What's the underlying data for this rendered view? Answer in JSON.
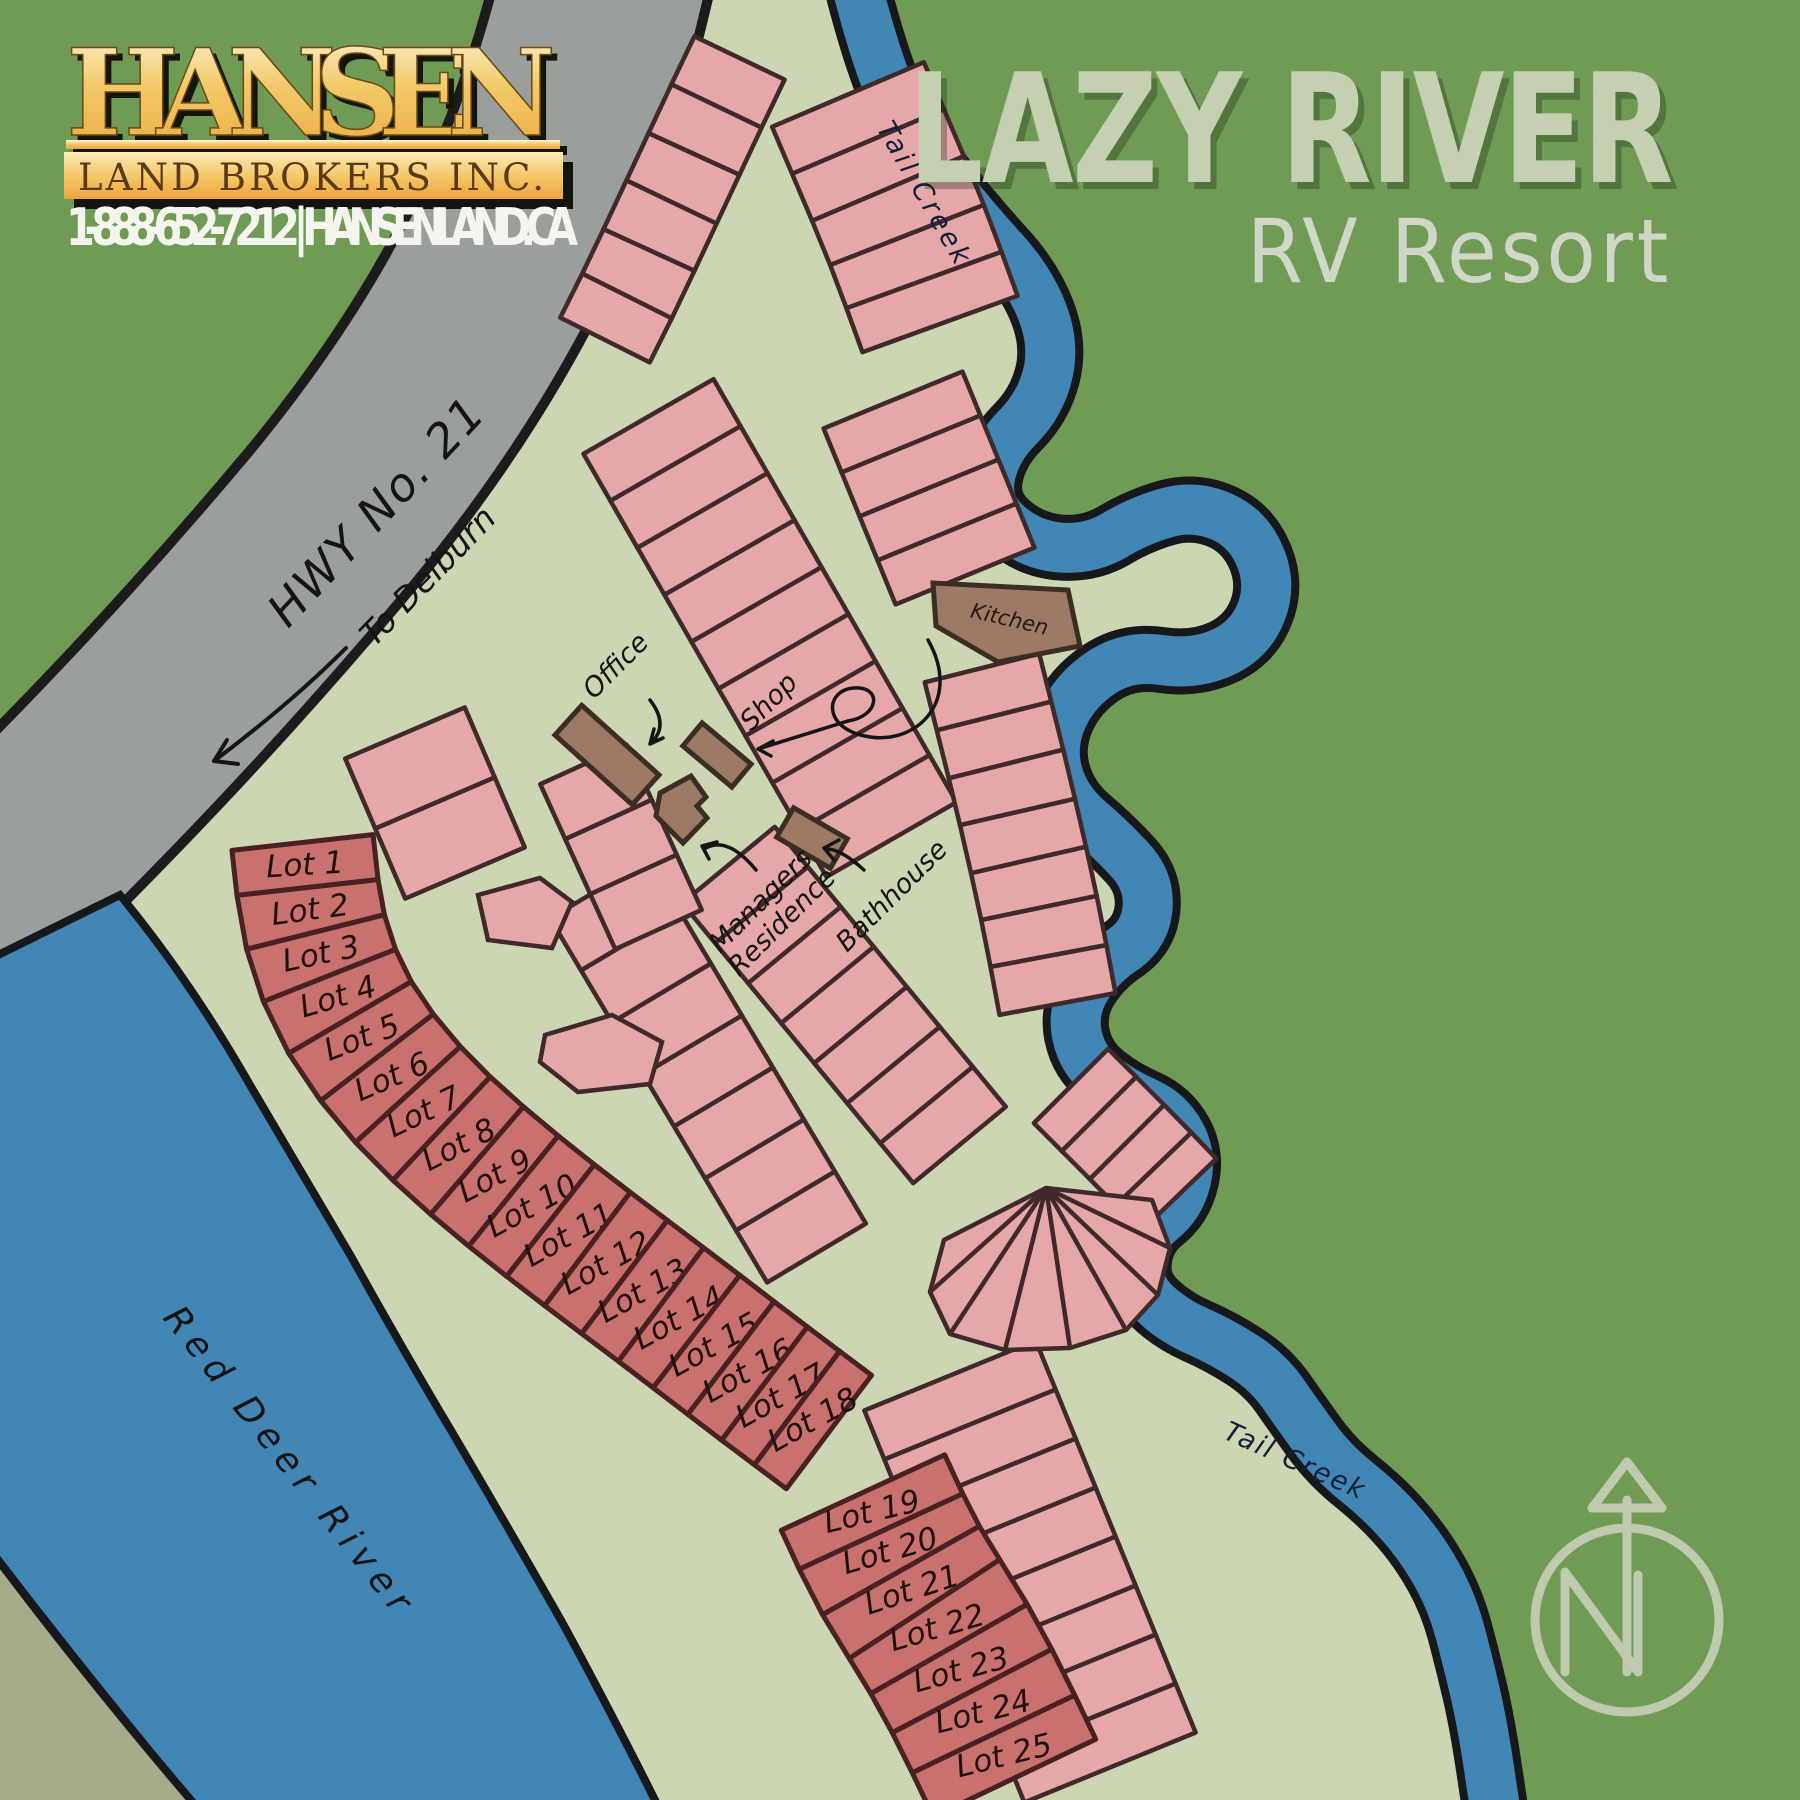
{
  "branding": {
    "name": "HANSEN",
    "tagline": "LAND BROKERS INC.",
    "contact": "1-888-652-7212 | HANSENLAND.CA"
  },
  "title": {
    "line1": "LAZY RIVER",
    "line2": "RV Resort"
  },
  "labels": {
    "highway": "HWY No. 21",
    "highway_direction": "To Delburn",
    "river": "Red Deer River",
    "creek_upper": "Tail Creek",
    "creek_lower": "Tail Creek",
    "office": "Office",
    "shop": "Shop",
    "managers_line1": "Managers",
    "managers_line2": "Residence",
    "bathhouse": "Bathhouse",
    "kitchen": "Kitchen",
    "compass": "N"
  },
  "lots": {
    "strip1": [
      "Lot 1",
      "Lot 2",
      "Lot 3",
      "Lot 4",
      "Lot 5",
      "Lot 6",
      "Lot 7",
      "Lot 8",
      "Lot 9",
      "Lot 10",
      "Lot 11",
      "Lot 12",
      "Lot 13",
      "Lot 14",
      "Lot 15",
      "Lot 16",
      "Lot 17",
      "Lot 18"
    ],
    "strip2": [
      "Lot 19",
      "Lot 20",
      "Lot 21",
      "Lot 22",
      "Lot 23",
      "Lot 24",
      "Lot 25"
    ]
  },
  "colors": {
    "background_green": "#6f9b54",
    "resort_green": "#cdd6b2",
    "water_blue": "#4186b5",
    "road_gray": "#9b9f9b",
    "far_bank_olive": "#a6ab8a",
    "site_pink": "#e6a7a9",
    "numbered_lot_red": "#c9716e",
    "building_brown": "#9c7a66",
    "logo_gold": "#efaf45",
    "title_sage": "#c5cfb2"
  }
}
